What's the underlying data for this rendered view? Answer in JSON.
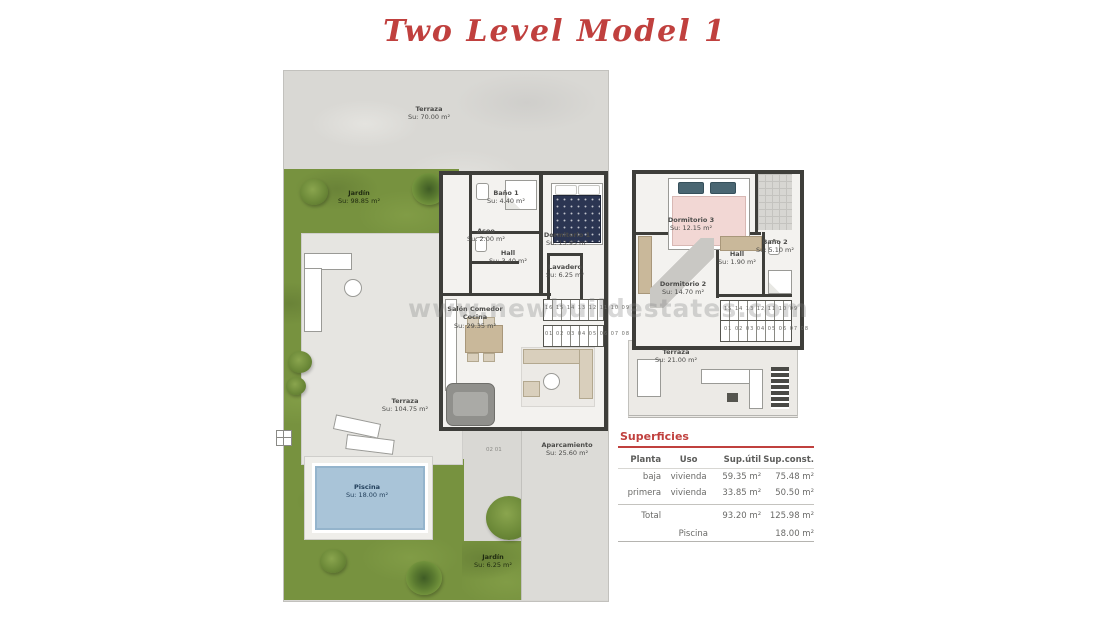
{
  "title": "Two Level Model 1",
  "watermark": "www.newbuildestates.com",
  "ground_floor": {
    "terraza_top": {
      "name": "Terraza",
      "area": "Su: 70.00 m²"
    },
    "jardin": {
      "name": "Jardín",
      "area": "Su: 98.85 m²"
    },
    "bano1": {
      "name": "Baño 1",
      "area": "Su: 4.40 m²"
    },
    "aseo": {
      "name": "Aseo",
      "area": "Su: 2.00 m²"
    },
    "dormitorio1": {
      "name": "Dormitorio 1",
      "area": "Su: 13.95 m²"
    },
    "hall": {
      "name": "Hall",
      "area": "Su: 3.40 m²"
    },
    "lavadero": {
      "name": "Lavadero",
      "area": "Su: 6.25 m²"
    },
    "salon": {
      "name": "Salón Comedor Cocina",
      "area": "Su: 29.35 m²"
    },
    "terraza_main": {
      "name": "Terraza",
      "area": "Su: 104.75 m²"
    },
    "piscina": {
      "name": "Piscina",
      "area": "Su: 18.00 m²"
    },
    "aparcamiento": {
      "name": "Aparcamiento",
      "area": "Su: 25.60 m²"
    },
    "jardin_small": {
      "name": "Jardín",
      "area": "Su: 6.25 m²"
    },
    "stairs_upper": "16 15 14 13 12 11 10 09",
    "stairs_lower": "01 02 03 04 05 06 07 08",
    "parking_marks": "02      01"
  },
  "first_floor": {
    "dormitorio3": {
      "name": "Dormitorio 3",
      "area": "Su: 12.15 m²"
    },
    "hall": {
      "name": "Hall",
      "area": "Su: 1.90 m²"
    },
    "bano2": {
      "name": "Baño 2",
      "area": "Su: 5.10 m²"
    },
    "dormitorio2": {
      "name": "Dormitorio 2",
      "area": "Su: 14.70 m²"
    },
    "terraza": {
      "name": "Terraza",
      "area": "Su: 21.00 m²"
    },
    "stairs_upper": "15 14 13 12 11 10 09",
    "stairs_lower": "01 02 03 04 05 06 07 08"
  },
  "table": {
    "title": "Superficies",
    "headers": [
      "Planta",
      "Uso",
      "Sup.útil",
      "Sup.const."
    ],
    "rows": [
      [
        "baja",
        "vivienda",
        "59.35 m²",
        "75.48 m²"
      ],
      [
        "primera",
        "vivienda",
        "33.85 m²",
        "50.50 m²"
      ]
    ],
    "total": {
      "label": "Total",
      "util": "93.20 m²",
      "const": "125.98 m²"
    },
    "piscina": {
      "label": "Piscina",
      "value": "18.00 m²"
    }
  },
  "colors": {
    "accent_red": "#c0403e",
    "garden_green": "#77923f",
    "pool_blue": "#a9c4d8",
    "wall_dark": "#3e3e3a",
    "concrete": "#d9d8d4"
  }
}
